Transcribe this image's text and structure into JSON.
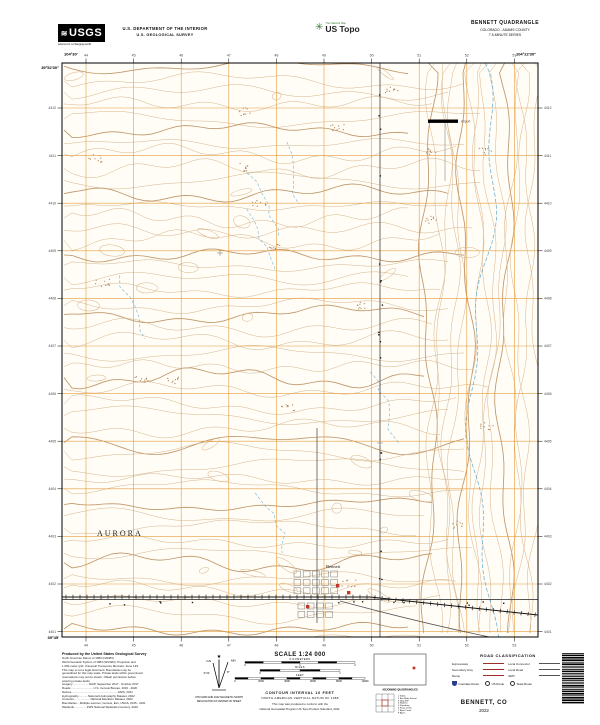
{
  "header": {
    "usgs_logo_text": "USGS",
    "usgs_tagline": "science for a changing world",
    "dept_line1": "U.S. DEPARTMENT OF THE INTERIOR",
    "dept_line2": "U.S. GEOLOGICAL SURVEY",
    "ustopo_tagline": "The National Map",
    "ustopo_brand": "US Topo",
    "quad_title": "BENNETT QUADRANGLE",
    "quad_subtitle": "COLORADO - ADAMS COUNTY",
    "quad_series": "7.5-MINUTE SERIES"
  },
  "map": {
    "colors": {
      "contour": "#d6b48c",
      "contour_index": "#c0976a",
      "grid": "#e59b3c",
      "water": "#6fb3d9",
      "road": "#555555",
      "rail": "#111111",
      "building": "#c0392b",
      "interstate": "#2b3f8f",
      "legend_red": "#9e2f26",
      "map_bg": "#fffdf6"
    },
    "place_labels": [
      {
        "text": "AURORA",
        "x": 57,
        "y": 488,
        "style": "city"
      },
      {
        "text": "Bennett",
        "x": 286,
        "y": 520,
        "style": "town"
      },
      {
        "text": "Airport",
        "x": 421,
        "y": 74.5,
        "style": "tiny"
      }
    ],
    "corner_labels": {
      "nw_lon": "104°30'",
      "nw_lat": "39°52'30\"",
      "ne_lon": "104°22'30\"",
      "sw_lat": "39°45'"
    },
    "top_grid_labels": [
      "44",
      "45",
      "46",
      "47",
      "48",
      "49",
      "50",
      "51",
      "52",
      "53"
    ],
    "left_grid_labels": [
      "4412",
      "4411",
      "4410",
      "4409",
      "4408",
      "4407",
      "4406",
      "4405",
      "4404",
      "4403",
      "4402",
      "4401"
    ]
  },
  "footer": {
    "produced": {
      "heading": "Produced by the United States Geological Survey",
      "lines": [
        "North American Datum of 1983 (NAD83)",
        "World Geodetic System of 1984 (WGS84). Projection and",
        "1 000-meter grid: Universal Transverse Mercator, Zone 13S",
        "This map is not a legal document. Boundaries may be",
        "generalized for this map scale. Private lands within government",
        "reservations may not be shown. Obtain permission before",
        "entering private lands.",
        " ",
        "Imagery.....................NAIP, September 2017 - October 2017",
        "Roads.............................U.S. Census Bureau, 2016 - 2020",
        "Names..........................................................GNIS, 2021",
        "Hydrography............National Hydrography Dataset, 2022",
        "Contours.....................National Elevation Dataset, 2022",
        "Boundaries....Multiple sources; Census, Esri, USGS, 2015 - 2021",
        "Wetlands................FWS National Wetlands Inventory, 2022"
      ]
    },
    "declination": {
      "star": "★",
      "gn": "GN",
      "mn": "MN",
      "gn_angle": "0°21'",
      "mn_angle": "8°",
      "caption1": "UTM GRID AND 2022 MAGNETIC NORTH",
      "caption2": "DECLINATION AT CENTER OF SHEET"
    },
    "scale": {
      "title": "SCALE 1:24 000",
      "rows": [
        {
          "label": "KILOMETERS",
          "segments": 6,
          "nums": [
            "0",
            "1",
            "2"
          ]
        },
        {
          "label": "MILES",
          "segments": 4,
          "nums": [
            "0",
            "1"
          ]
        },
        {
          "label": "FEET",
          "segments": 10,
          "nums": [
            "0",
            "2000",
            "4000",
            "6000",
            "8000",
            "10000"
          ]
        }
      ],
      "contour": "CONTOUR INTERVAL 10 FEET",
      "datum": "NORTH AMERICAN VERTICAL DATUM OF 1988",
      "conform1": "This map was produced to conform with the",
      "conform2": "National Geospatial Program US Topo Product Standard, 2011."
    },
    "location": {
      "heading": "ADJOINING QUADRANGLES",
      "quads": [
        "1 Sable",
        "2 Box Elder School",
        "3 Hoyt SW",
        "4 Watkins",
        "5 Strasburg",
        "6 Piney Creek",
        "7 Bijou Creek",
        "8 Byers"
      ]
    },
    "road_class": {
      "title": "ROAD CLASSIFICATION",
      "rows": [
        {
          "left": "Expressway",
          "right": "Local Connector"
        },
        {
          "left": "Secondary Hwy",
          "right": "Local Road"
        },
        {
          "left": "Ramp",
          "right": "4WD"
        }
      ],
      "routes": [
        {
          "type": "interstate",
          "label": "Interstate Route"
        },
        {
          "type": "us",
          "label": "US Route"
        },
        {
          "type": "state",
          "label": "State Route"
        }
      ]
    },
    "imprint": {
      "name": "BENNETT, CO",
      "year": "2022"
    }
  }
}
